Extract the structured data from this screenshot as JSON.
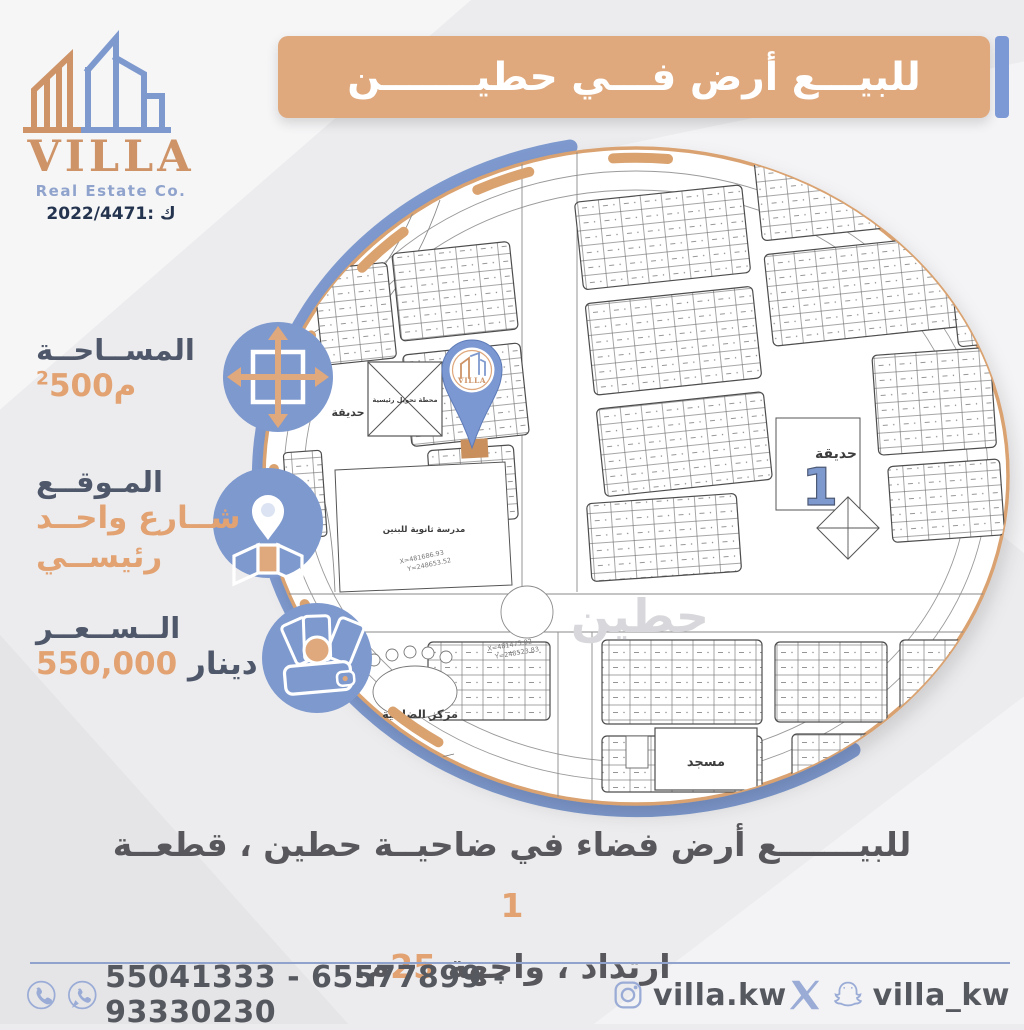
{
  "brand": {
    "name": "VILLA",
    "subtitle": "Real Estate Co.",
    "license": "2022/4471: ك"
  },
  "header": {
    "title": "للبيـــع أرض فـــي حطيـــــــن"
  },
  "info": {
    "area_label": "المســاحــة",
    "area_value": "500م",
    "area_sup": "2",
    "location_label": "المـوقــع",
    "location_line1": "شــارع واحــد",
    "location_line2": "رئيســي",
    "price_label": "الــســعــر",
    "price_value": "550,000",
    "price_unit": "دينار"
  },
  "map": {
    "park_left": "حديقة",
    "station": "محطة تحويل رئيسية",
    "school": "مدرسة ثانوية للبنين",
    "park_right": "حديقة",
    "park_number": "1",
    "mosque": "مسجد",
    "district_center": "مركز الضاحية",
    "watermark": "حطين",
    "coord_x1": "X=481475.02",
    "coord_y1": "Y=248523.83",
    "coord_x2": "X=481686.93",
    "coord_y2": "Y=248653.52",
    "pin_brand": "VILLA"
  },
  "description": {
    "line1_text": "للبيـــــــع أرض فضاء في ضاحيــة حطين ، قطعــة",
    "line1_number": "1",
    "line2_text": "ارتداد ، واجهة",
    "line2_number": "25",
    "line2_suffix": "م."
  },
  "footer": {
    "phones": "55041333 - 65577899 - 93330230",
    "instagram_handle": "villa.kw",
    "social_handle": "villa_kw"
  },
  "colors": {
    "copper": "#DFA87D",
    "copper_dark": "#C9905E",
    "blue": "#7E99CE",
    "dark_text": "#4E586A",
    "orange_text": "#E2A272",
    "footer_icon": "#9AACD6"
  }
}
